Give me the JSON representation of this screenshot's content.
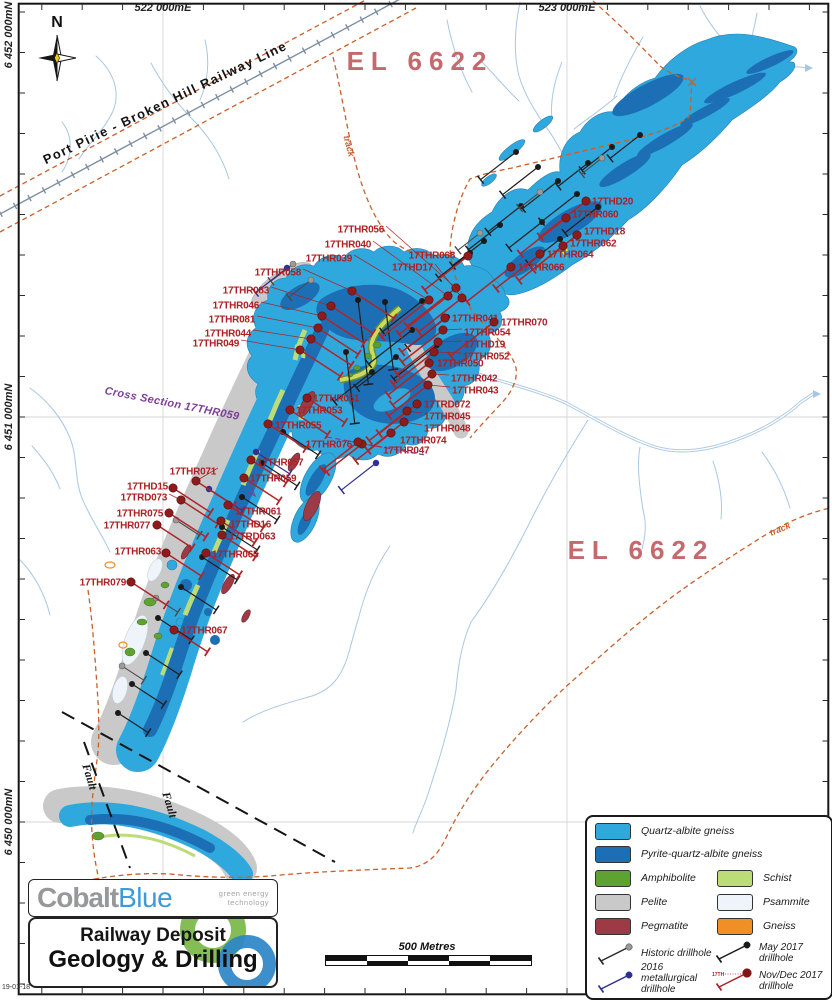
{
  "frame": {
    "date_stamp": "19-01-18"
  },
  "north_arrow": {
    "label": "N"
  },
  "grid": {
    "eastings": [
      {
        "label": "522 000mE",
        "x": 163
      },
      {
        "label": "523 000mE",
        "x": 567
      }
    ],
    "northings": [
      {
        "label": "6 452 000mN",
        "y": 35
      },
      {
        "label": "6 451 000mN",
        "y": 417
      },
      {
        "label": "6 450 000mN",
        "y": 822
      }
    ]
  },
  "map_labels": {
    "tenement_north": "EL 6622",
    "tenement_south": "EL 6622",
    "railway": "Port Pirie  -  Broken Hill Railway Line",
    "track_north": "track",
    "track_east": "track",
    "fault_upper": "Fault",
    "fault_lower": "Fault",
    "cross_section": "Cross Section 17THR059"
  },
  "scale_bar": {
    "label": "500 Metres"
  },
  "title_block": {
    "brand_1": "Cobalt",
    "brand_2": "Blue",
    "tagline_1": "green energy",
    "tagline_2": "technology",
    "title_line1": "Railway Deposit",
    "title_line2": "Geology & Drilling"
  },
  "legend": {
    "rocks": [
      {
        "label": "Quartz-albite gneiss",
        "color": "#2fa8dd"
      },
      {
        "label": "Pyrite-quartz-albite gneiss",
        "color": "#1d6fb5"
      },
      {
        "label": "Amphibolite",
        "color": "#5fa231"
      },
      {
        "label": "Schist",
        "color": "#bcdc78"
      },
      {
        "label": "Pelite",
        "color": "#c9c9c9"
      },
      {
        "label": "Psammite",
        "color": "#eef4f9"
      },
      {
        "label": "Pegmatite",
        "color": "#9c3a46"
      },
      {
        "label": "Gneiss",
        "color": "#ef8f25"
      }
    ],
    "drill_types": [
      {
        "label": "Historic drillhole",
        "line": "#2a2a2a",
        "dot": "#9a9a9a"
      },
      {
        "label": "May 2017 drillhole",
        "line": "#1a1a1a",
        "dot": "#1a1a1a"
      },
      {
        "label": "2016 metallurgical drillhole",
        "line": "#2e3192",
        "dot": "#2e3192"
      },
      {
        "label": "Nov/Dec 2017 drillhole",
        "line": "#a62125",
        "dot": "#7e1517",
        "tag": "17TH"
      }
    ]
  },
  "palette": {
    "quartz": "#2fa8dd",
    "pyrite": "#1d6fb5",
    "amph": "#5fa231",
    "schist": "#bcdc78",
    "pelite": "#c9c9c9",
    "psam": "#eef4f9",
    "pegm": "#9c3a46",
    "gneiss": "#ef8f25",
    "lred": "#ae2024",
    "dred": "#8e1b1c",
    "may": "#1a1a1a",
    "hist": "#9a9a9a",
    "met": "#2e3192",
    "track": "#c95f2a",
    "stream": "#a9c7e4",
    "rail": "#7d8ea3",
    "pink": "#c4696c",
    "purple": "#7d3f98"
  },
  "drillholes": [
    {
      "l": "17THR056",
      "x": 384,
      "y": 229,
      "a": "e",
      "dx": 456,
      "dy": 288,
      "d": "sw",
      "L": 62
    },
    {
      "l": "17THR040",
      "x": 371,
      "y": 244,
      "a": "e",
      "dx": 448,
      "dy": 296,
      "d": "sw",
      "L": 62
    },
    {
      "l": "17THR039",
      "x": 352,
      "y": 258,
      "a": "e",
      "dx": 429,
      "dy": 300,
      "d": "sw",
      "L": 60
    },
    {
      "l": "17THR058",
      "x": 301,
      "y": 272,
      "a": "e",
      "dx": 352,
      "dy": 291,
      "d": "se",
      "L": 50
    },
    {
      "l": "17THR083",
      "x": 269,
      "y": 290,
      "a": "e",
      "dx": 331,
      "dy": 306,
      "d": "se",
      "L": 50
    },
    {
      "l": "17THR046",
      "x": 259,
      "y": 305,
      "a": "e",
      "dx": 322,
      "dy": 316,
      "d": "se",
      "L": 50
    },
    {
      "l": "17THR081",
      "x": 255,
      "y": 319,
      "a": "e",
      "dx": 318,
      "dy": 328,
      "d": "se",
      "L": 48
    },
    {
      "l": "17THR044",
      "x": 251,
      "y": 333,
      "a": "e",
      "dx": 311,
      "dy": 339,
      "d": "se",
      "L": 48
    },
    {
      "l": "17THR049",
      "x": 239,
      "y": 343,
      "a": "e",
      "dx": 300,
      "dy": 350,
      "d": "se",
      "L": 48
    },
    {
      "l": "17THD17",
      "x": 433,
      "y": 267,
      "a": "e",
      "dx": 462,
      "dy": 298,
      "d": "sw",
      "L": 55
    },
    {
      "l": "17THR068",
      "x": 455,
      "y": 255,
      "a": "e",
      "dx": 468,
      "dy": 256,
      "d": "sw",
      "L": 55
    },
    {
      "l": "17THD20",
      "x": 592,
      "y": 201,
      "a": "s",
      "dx": 586,
      "dy": 201,
      "d": "sw",
      "L": 58
    },
    {
      "l": "17THR060",
      "x": 572,
      "y": 214,
      "a": "s",
      "dx": 566,
      "dy": 218,
      "d": "sw",
      "L": 58
    },
    {
      "l": "17THD18",
      "x": 584,
      "y": 231,
      "a": "s",
      "dx": 577,
      "dy": 235,
      "d": "sw",
      "L": 56
    },
    {
      "l": "17THR062",
      "x": 570,
      "y": 243,
      "a": "s",
      "dx": 563,
      "dy": 246,
      "d": "sw",
      "L": 56
    },
    {
      "l": "17THR064",
      "x": 547,
      "y": 254,
      "a": "s",
      "dx": 540,
      "dy": 254,
      "d": "sw",
      "L": 56
    },
    {
      "l": "17THR066",
      "x": 518,
      "y": 267,
      "a": "s",
      "dx": 511,
      "dy": 267,
      "d": "sw",
      "L": 56
    },
    {
      "l": "17THR041",
      "x": 452,
      "y": 318,
      "a": "s",
      "dx": 445,
      "dy": 318,
      "d": "sw",
      "L": 55
    },
    {
      "l": "17THR070",
      "x": 501,
      "y": 322,
      "a": "s",
      "dx": 494,
      "dy": 322,
      "d": "sw",
      "L": 55
    },
    {
      "l": "17THR054",
      "x": 464,
      "y": 332,
      "a": "s",
      "dx": 443,
      "dy": 330,
      "d": "sw",
      "L": 52
    },
    {
      "l": "17THD19",
      "x": 464,
      "y": 344,
      "a": "s",
      "dx": 438,
      "dy": 342,
      "d": "sw",
      "L": 52
    },
    {
      "l": "17THR052",
      "x": 463,
      "y": 356,
      "a": "s",
      "dx": 434,
      "dy": 352,
      "d": "sw",
      "L": 52
    },
    {
      "l": "17THR050",
      "x": 437,
      "y": 363,
      "a": "s",
      "dx": 429,
      "dy": 363,
      "d": "sw",
      "L": 52
    },
    {
      "l": "17THR042",
      "x": 451,
      "y": 378,
      "a": "s",
      "dx": 432,
      "dy": 374,
      "d": "sw",
      "L": 50
    },
    {
      "l": "17THR043",
      "x": 452,
      "y": 390,
      "a": "s",
      "dx": 428,
      "dy": 385,
      "d": "sw",
      "L": 50
    },
    {
      "l": "17TRD072",
      "x": 424,
      "y": 404,
      "a": "s",
      "dx": 417,
      "dy": 404,
      "d": "sw",
      "L": 48
    },
    {
      "l": "17THR045",
      "x": 424,
      "y": 416,
      "a": "s",
      "dx": 407,
      "dy": 411,
      "d": "sw",
      "L": 48
    },
    {
      "l": "17THR048",
      "x": 424,
      "y": 428,
      "a": "s",
      "dx": 404,
      "dy": 422,
      "d": "sw",
      "L": 46
    },
    {
      "l": "17THR074",
      "x": 400,
      "y": 440,
      "a": "s",
      "dx": 391,
      "dy": 433,
      "d": "sw",
      "L": 45
    },
    {
      "l": "17THR047",
      "x": 383,
      "y": 450,
      "a": "s",
      "dx": 362,
      "dy": 444,
      "d": "sw",
      "L": 45
    },
    {
      "l": "17THR076",
      "x": 352,
      "y": 444,
      "a": "e",
      "dx": 358,
      "dy": 442,
      "d": "sw",
      "L": 45
    },
    {
      "l": "17THR051",
      "x": 313,
      "y": 398,
      "a": "s",
      "dx": 307,
      "dy": 398,
      "d": "se",
      "L": 45
    },
    {
      "l": "17THR053",
      "x": 296,
      "y": 410,
      "a": "s",
      "dx": 290,
      "dy": 410,
      "d": "se",
      "L": 45
    },
    {
      "l": "17THR055",
      "x": 275,
      "y": 425,
      "a": "s",
      "dx": 268,
      "dy": 424,
      "d": "se",
      "L": 45
    },
    {
      "l": "17THR057",
      "x": 257,
      "y": 462,
      "a": "s",
      "dx": 251,
      "dy": 460,
      "d": "se",
      "L": 42
    },
    {
      "l": "17THR059",
      "x": 250,
      "y": 478,
      "a": "s",
      "dx": 244,
      "dy": 478,
      "d": "se",
      "L": 42
    },
    {
      "l": "17THR061",
      "x": 235,
      "y": 511,
      "a": "s",
      "dx": 228,
      "dy": 505,
      "d": "se",
      "L": 42
    },
    {
      "l": "17THD16",
      "x": 230,
      "y": 524,
      "a": "s",
      "dx": 221,
      "dy": 521,
      "d": "se",
      "L": 40
    },
    {
      "l": "17TRD063",
      "x": 229,
      "y": 536,
      "a": "s",
      "dx": 222,
      "dy": 535,
      "d": "se",
      "L": 40
    },
    {
      "l": "17THR065",
      "x": 212,
      "y": 554,
      "a": "s",
      "dx": 206,
      "dy": 553,
      "d": "se",
      "L": 40
    },
    {
      "l": "17THR071",
      "x": 216,
      "y": 471,
      "a": "e",
      "dx": 196,
      "dy": 481,
      "d": "se",
      "L": 45
    },
    {
      "l": "17THD15",
      "x": 168,
      "y": 486,
      "a": "e",
      "dx": 173,
      "dy": 488,
      "d": "se",
      "L": 45
    },
    {
      "l": "17TRD073",
      "x": 167,
      "y": 497,
      "a": "e",
      "dx": 181,
      "dy": 500,
      "d": "se",
      "L": 44
    },
    {
      "l": "17THR075",
      "x": 163,
      "y": 513,
      "a": "e",
      "dx": 169,
      "dy": 513,
      "d": "se",
      "L": 44
    },
    {
      "l": "17THR077",
      "x": 150,
      "y": 525,
      "a": "e",
      "dx": 157,
      "dy": 525,
      "d": "se",
      "L": 42
    },
    {
      "l": "17THR063",
      "x": 161,
      "y": 551,
      "a": "e",
      "dx": 166,
      "dy": 553,
      "d": "se",
      "L": 42
    },
    {
      "l": "17THR079",
      "x": 126,
      "y": 582,
      "a": "e",
      "dx": 131,
      "dy": 582,
      "d": "se",
      "L": 42
    },
    {
      "l": "17THR067",
      "x": 181,
      "y": 630,
      "a": "s",
      "dx": 174,
      "dy": 630,
      "d": "se",
      "L": 40
    }
  ],
  "unlabeled_drillholes": {
    "may2017": [
      [
        516,
        152,
        "sw",
        45
      ],
      [
        538,
        167,
        "sw",
        45
      ],
      [
        558,
        181,
        "sw",
        45
      ],
      [
        577,
        194,
        "sw",
        45
      ],
      [
        598,
        207,
        "sw",
        42
      ],
      [
        521,
        206,
        "sw",
        42
      ],
      [
        542,
        222,
        "sw",
        42
      ],
      [
        500,
        225,
        "sw",
        40
      ],
      [
        484,
        241,
        "sw",
        40
      ],
      [
        560,
        239,
        "sw",
        40
      ],
      [
        612,
        147,
        "sw",
        38
      ],
      [
        588,
        163,
        "sw",
        38
      ],
      [
        640,
        135,
        "sw",
        38
      ],
      [
        470,
        253,
        "sw",
        40
      ],
      [
        358,
        300,
        "s",
        85
      ],
      [
        385,
        302,
        "s",
        68
      ],
      [
        346,
        352,
        "s",
        72
      ],
      [
        412,
        330,
        "sw",
        55
      ],
      [
        437,
        345,
        "sw",
        55
      ],
      [
        396,
        357,
        "sw",
        50
      ],
      [
        372,
        372,
        "sw",
        48
      ],
      [
        422,
        301,
        "sw",
        50
      ],
      [
        447,
        317,
        "sw",
        50
      ],
      [
        283,
        432,
        "se",
        42
      ],
      [
        262,
        463,
        "se",
        42
      ],
      [
        242,
        497,
        "se",
        42
      ],
      [
        222,
        527,
        "se",
        42
      ],
      [
        202,
        557,
        "se",
        42
      ],
      [
        181,
        587,
        "se",
        42
      ],
      [
        158,
        618,
        "se",
        40
      ],
      [
        146,
        653,
        "se",
        40
      ],
      [
        132,
        684,
        "se",
        38
      ],
      [
        118,
        713,
        "se",
        36
      ]
    ],
    "historic": [
      [
        293,
        264,
        "sw",
        28
      ],
      [
        311,
        280,
        "sw",
        28
      ],
      [
        480,
        233,
        "sw",
        28
      ],
      [
        176,
        520,
        "se",
        28
      ],
      [
        156,
        598,
        "se",
        26
      ],
      [
        122,
        666,
        "se",
        26
      ],
      [
        540,
        192,
        "sw",
        26
      ],
      [
        602,
        158,
        "sw",
        26
      ]
    ],
    "met2016": [
      [
        287,
        268,
        "sw",
        40
      ],
      [
        256,
        452,
        "se",
        40
      ],
      [
        376,
        463,
        "sw",
        44
      ],
      [
        209,
        489,
        "se",
        40
      ]
    ]
  }
}
